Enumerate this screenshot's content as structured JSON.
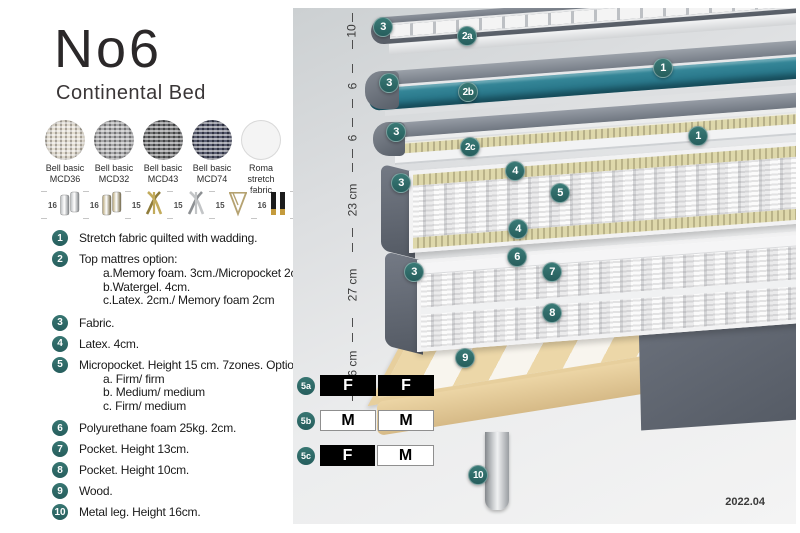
{
  "header": {
    "title": "No6",
    "subtitle": "Continental Bed"
  },
  "fabrics": [
    {
      "name": "Bell basic",
      "code": "MCD36",
      "swatch": "cream"
    },
    {
      "name": "Bell basic",
      "code": "MCD32",
      "swatch": "gray"
    },
    {
      "name": "Bell basic",
      "code": "MCD43",
      "swatch": "darkgray"
    },
    {
      "name": "Bell basic",
      "code": "MCD74",
      "swatch": "navy"
    },
    {
      "name": "Roma",
      "code": "stretch fabric",
      "swatch": "white"
    }
  ],
  "legs": [
    {
      "height": "16",
      "style": "cylinder-silver"
    },
    {
      "height": "16",
      "style": "cylinder-brass"
    },
    {
      "height": "15",
      "style": "twist-gold"
    },
    {
      "height": "15",
      "style": "twist-silver"
    },
    {
      "height": "15",
      "style": "hairpin-gold"
    },
    {
      "height": "16",
      "style": "black-gold"
    }
  ],
  "features": [
    {
      "num": "1",
      "text": "Stretch fabric quilted with wadding."
    },
    {
      "num": "2",
      "text": "Top mattres option:",
      "options": [
        "a.Memory foam. 3cm./Micropocket 2cm",
        "b.Watergel. 4cm.",
        "c.Latex. 2cm./ Memory foam 2cm"
      ]
    },
    {
      "num": "3",
      "text": "Fabric."
    },
    {
      "num": "4",
      "text": "Latex. 4cm."
    },
    {
      "num": "5",
      "text": "Micropocket. Height 15 cm. 7zones. Option:",
      "options": [
        "a. Firm/ firm",
        "b. Medium/ medium",
        "c. Firm/ medium"
      ]
    },
    {
      "num": "6",
      "text": "Polyurethane foam 25kg. 2cm."
    },
    {
      "num": "7",
      "text": "Pocket. Height 13cm."
    },
    {
      "num": "8",
      "text": "Pocket. Height 10cm."
    },
    {
      "num": "9",
      "text": "Wood."
    },
    {
      "num": "10",
      "text": "Metal leg. Height 16cm."
    }
  ],
  "diagram": {
    "measurements": [
      {
        "label": "10",
        "top": 5,
        "height": 36
      },
      {
        "label": "6",
        "top": 56,
        "height": 44
      },
      {
        "label": "6",
        "top": 110,
        "height": 40
      },
      {
        "label": "23 cm",
        "top": 155,
        "height": 74
      },
      {
        "label": "27 cm",
        "top": 235,
        "height": 84
      },
      {
        "label": "16 cm",
        "top": 325,
        "height": 68
      }
    ],
    "badges": [
      {
        "label": "3",
        "x": 90,
        "y": 19
      },
      {
        "label": "2a",
        "x": 174,
        "y": 28
      },
      {
        "label": "1",
        "x": 370,
        "y": 60
      },
      {
        "label": "3",
        "x": 96,
        "y": 75
      },
      {
        "label": "2b",
        "x": 175,
        "y": 84
      },
      {
        "label": "3",
        "x": 103,
        "y": 124
      },
      {
        "label": "1",
        "x": 405,
        "y": 128
      },
      {
        "label": "2c",
        "x": 177,
        "y": 139
      },
      {
        "label": "4",
        "x": 222,
        "y": 163
      },
      {
        "label": "3",
        "x": 108,
        "y": 175
      },
      {
        "label": "5",
        "x": 267,
        "y": 185
      },
      {
        "label": "4",
        "x": 225,
        "y": 221
      },
      {
        "label": "6",
        "x": 224,
        "y": 249
      },
      {
        "label": "3",
        "x": 121,
        "y": 264
      },
      {
        "label": "7",
        "x": 259,
        "y": 264
      },
      {
        "label": "8",
        "x": 259,
        "y": 305
      },
      {
        "label": "9",
        "x": 172,
        "y": 350
      },
      {
        "label": "10",
        "x": 185,
        "y": 467
      }
    ],
    "comfort_table": [
      {
        "label": "5a",
        "cells": [
          {
            "text": "F",
            "variant": "dark"
          },
          {
            "text": "F",
            "variant": "dark"
          }
        ]
      },
      {
        "label": "5b",
        "cells": [
          {
            "text": "M",
            "variant": "light"
          },
          {
            "text": "M",
            "variant": "light"
          }
        ]
      },
      {
        "label": "5c",
        "cells": [
          {
            "text": "F",
            "variant": "dark"
          },
          {
            "text": "M",
            "variant": "light"
          }
        ]
      }
    ],
    "version": "2022.04"
  },
  "colors": {
    "badge_teal": "#2e6f6e",
    "watergel_teal": "#2b8093",
    "cover_gray": "#636a76",
    "latex_cream": "#ded8ab",
    "wood_tan": "#ecd7a8",
    "leg_chrome": "#c9ccce",
    "table_dark": "#000000"
  }
}
